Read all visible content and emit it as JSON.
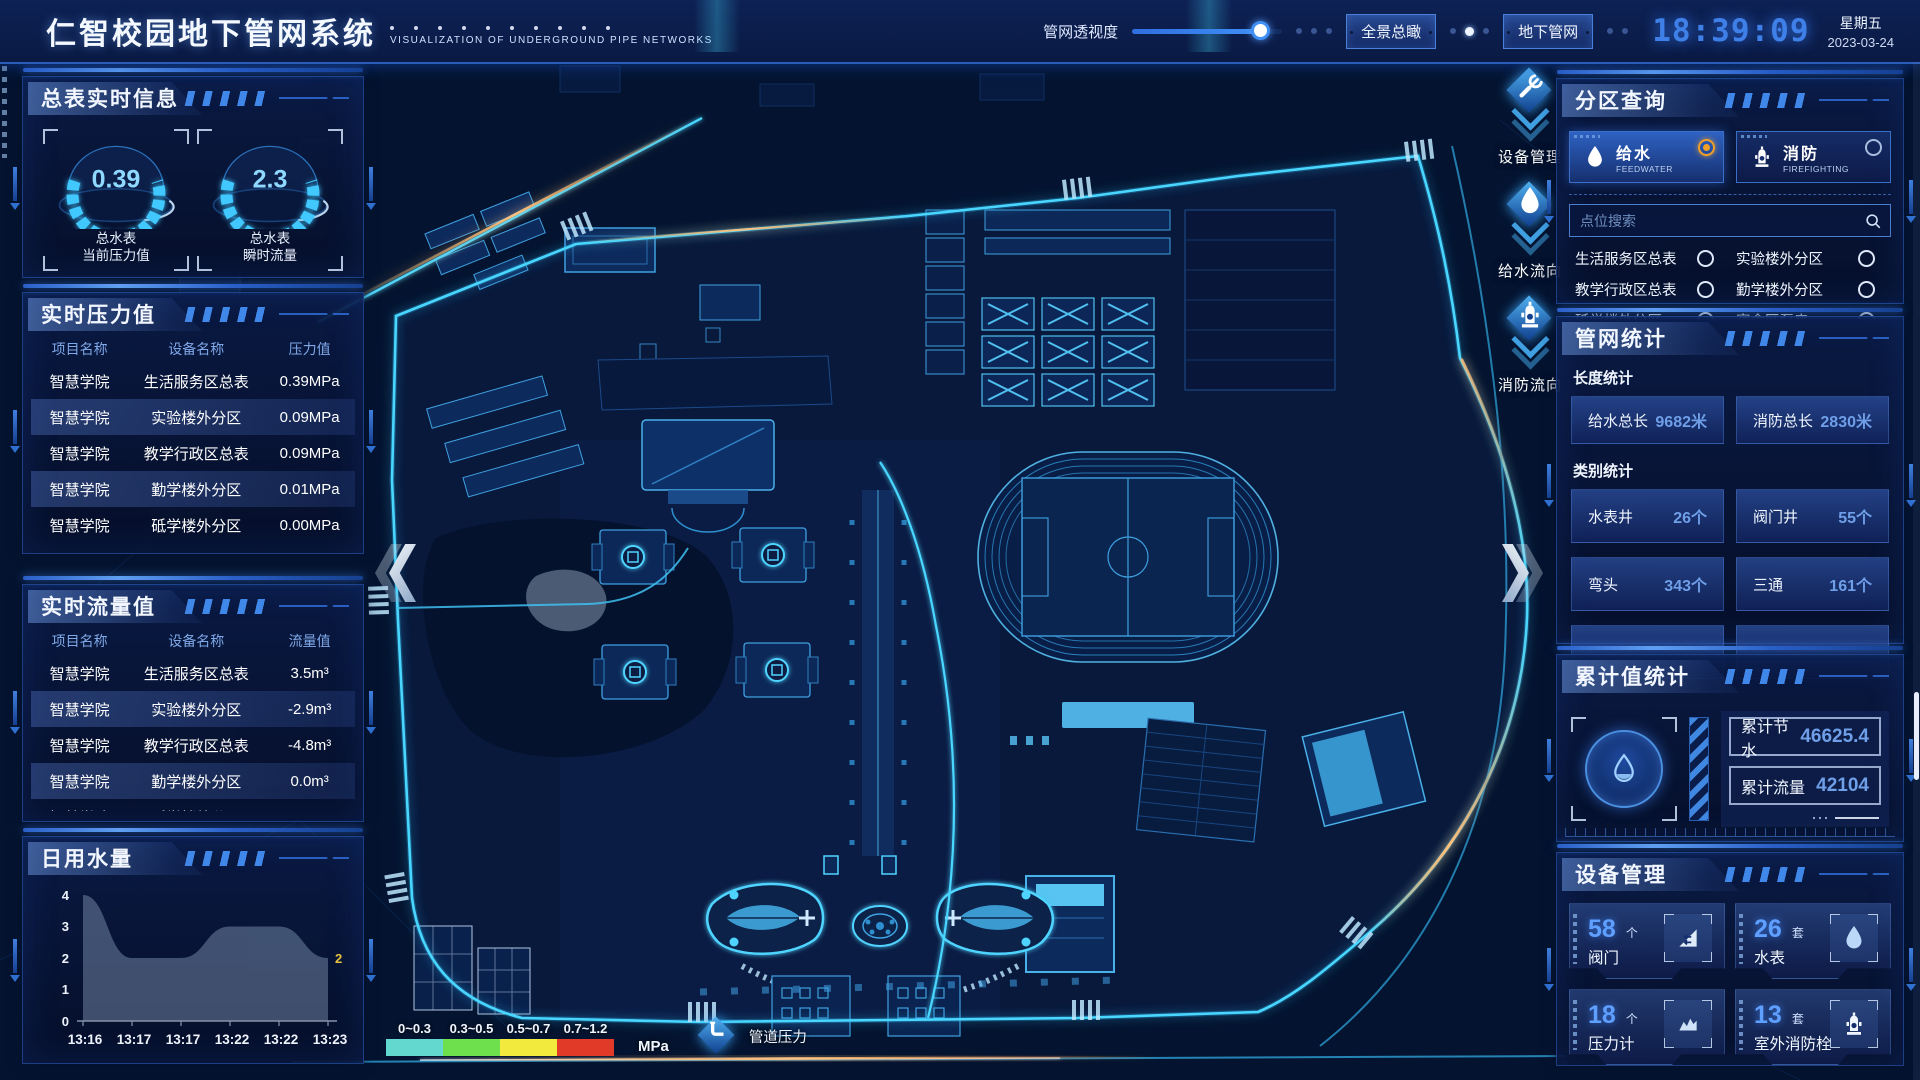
{
  "header": {
    "title": "仁智校园地下管网系统",
    "subtitle": "VISUALIZATION OF UNDERGROUND PIPE NETWORKS",
    "opacity_label": "管网透视度",
    "slider_pct": 86,
    "btn_overview": "全景总瞰",
    "btn_underground": "地下管网",
    "time": "18:39:09",
    "weekday": "星期五",
    "date": "2023-03-24"
  },
  "left": {
    "realtime": {
      "title": "总表实时信息",
      "gauges": [
        {
          "value": "0.39",
          "label1": "总水表",
          "label2": "当前压力值"
        },
        {
          "value": "2.3",
          "label1": "总水表",
          "label2": "瞬时流量"
        }
      ]
    },
    "pressure": {
      "title": "实时压力值",
      "headers": [
        "项目名称",
        "设备名称",
        "压力值"
      ],
      "rows": [
        [
          "智慧学院",
          "生活服务区总表",
          "0.39MPa"
        ],
        [
          "智慧学院",
          "实验楼外分区",
          "0.09MPa"
        ],
        [
          "智慧学院",
          "教学行政区总表",
          "0.09MPa"
        ],
        [
          "智慧学院",
          "勤学楼外分区",
          "0.01MPa"
        ],
        [
          "智慧学院",
          "砥学楼外分区",
          "0.00MPa"
        ]
      ]
    },
    "flow": {
      "title": "实时流量值",
      "headers": [
        "项目名称",
        "设备名称",
        "流量值"
      ],
      "rows": [
        [
          "智慧学院",
          "生活服务区总表",
          "3.5m³"
        ],
        [
          "智慧学院",
          "实验楼外分区",
          "-2.9m³"
        ],
        [
          "智慧学院",
          "教学行政区总表",
          "-4.8m³"
        ],
        [
          "智慧学院",
          "勤学楼外分区",
          "0.0m³"
        ],
        [
          "智慧学院",
          "砥学楼外分区",
          "-2.2m³"
        ]
      ]
    }
  },
  "chart_data": {
    "type": "area",
    "title": "日用水量",
    "x": [
      "13:16",
      "13:17",
      "13:17",
      "13:22",
      "13:22",
      "13:23"
    ],
    "values": [
      4,
      2,
      2,
      3,
      3,
      2
    ],
    "yticks": [
      0,
      1,
      2,
      3,
      4
    ],
    "ylim": [
      0,
      4
    ],
    "grid": false,
    "end_label": "2",
    "area_color": "rgba(150,172,200,0.40)",
    "end_label_color": "#e8c23f"
  },
  "map": {
    "buttons": [
      {
        "label": "设备管理",
        "icon": "tools-icon"
      },
      {
        "label": "给水流向",
        "icon": "water-drop-icon"
      },
      {
        "label": "消防流向",
        "icon": "hydrant-icon"
      }
    ],
    "legend": {
      "ranges": [
        {
          "label": "0~0.3",
          "color": "#63d8cf"
        },
        {
          "label": "0.3~0.5",
          "color": "#6ee04e"
        },
        {
          "label": "0.5~0.7",
          "color": "#f2ea3d"
        },
        {
          "label": "0.7~1.2",
          "color": "#e23a28"
        }
      ],
      "unit": "MPa",
      "pressure_label": "管道压力"
    }
  },
  "right": {
    "zone": {
      "title": "分区查询",
      "feed": {
        "cn": "给水",
        "en": "FEEDWATER",
        "selected": true
      },
      "fire": {
        "cn": "消防",
        "en": "FIREFIGHTING",
        "selected": false
      },
      "search_placeholder": "点位搜索",
      "items": [
        "生活服务区总表",
        "实验楼外分区",
        "教学行政区总表",
        "勤学楼外分区",
        "砥学楼外分区",
        "宿舍区泵房"
      ]
    },
    "stats": {
      "title": "管网统计",
      "length_title": "长度统计",
      "length": [
        {
          "label": "给水总长",
          "value": "9682米"
        },
        {
          "label": "消防总长",
          "value": "2830米"
        }
      ],
      "category_title": "类别统计",
      "category": [
        {
          "label": "水表井",
          "value": "26个"
        },
        {
          "label": "阀门井",
          "value": "55个"
        },
        {
          "label": "弯头",
          "value": "343个"
        },
        {
          "label": "三通",
          "value": "161个"
        }
      ]
    },
    "acc": {
      "title": "累计值统计",
      "rows": [
        {
          "label": "累计节水",
          "value": "46625.4"
        },
        {
          "label": "累计流量",
          "value": "42104"
        }
      ]
    },
    "devices": {
      "title": "设备管理",
      "cards": [
        {
          "count": "58",
          "unit": "个",
          "label": "阀门",
          "icon": "valve-icon"
        },
        {
          "count": "26",
          "unit": "套",
          "label": "水表",
          "icon": "water-meter-icon"
        },
        {
          "count": "18",
          "unit": "个",
          "label": "压力计",
          "icon": "pressure-gauge-icon"
        },
        {
          "count": "13",
          "unit": "套",
          "label": "室外消防栓",
          "icon": "hydrant-icon"
        }
      ]
    }
  }
}
